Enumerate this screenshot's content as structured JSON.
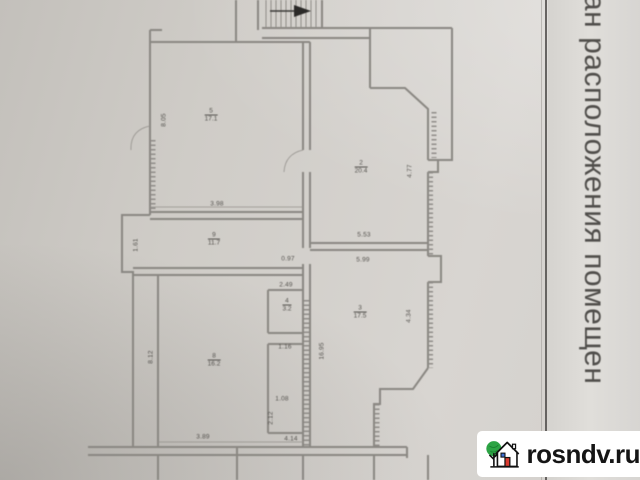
{
  "page": {
    "side_caption": "ан расположения помещен",
    "watermark": {
      "text": "rosndv.ru"
    }
  },
  "colors": {
    "paper": "#d2cfca",
    "plan_line": "#8a8782",
    "label_ink": "#55534f",
    "divider": "#514f4c",
    "watermark_bg": "#ffffff",
    "watermark_text": "#151515",
    "logo_green": "#2ca344",
    "logo_red": "#d93a2f",
    "logo_blue": "#3b6fd4"
  },
  "plan": {
    "room_labels": [
      {
        "num": "5",
        "area": "17.1",
        "x": 211,
        "y": 115
      },
      {
        "num": "2",
        "area": "20.4",
        "x": 361,
        "y": 167
      },
      {
        "num": "9",
        "area": "11.7",
        "x": 214,
        "y": 239
      },
      {
        "num": "4",
        "area": "3.2",
        "x": 287,
        "y": 305
      },
      {
        "num": "3",
        "area": "17.5",
        "x": 360,
        "y": 312
      },
      {
        "num": "8",
        "area": "16.2",
        "x": 214,
        "y": 360
      }
    ],
    "dimensions": [
      {
        "t": "8.05",
        "x": 164,
        "y": 120,
        "v": true
      },
      {
        "t": "3.98",
        "x": 217,
        "y": 204
      },
      {
        "t": "1.61",
        "x": 136,
        "y": 245,
        "v": true
      },
      {
        "t": "0.97",
        "x": 288,
        "y": 259
      },
      {
        "t": "5.53",
        "x": 364,
        "y": 235
      },
      {
        "t": "5.99",
        "x": 363,
        "y": 260
      },
      {
        "t": "4.77",
        "x": 410,
        "y": 171,
        "v": true
      },
      {
        "t": "4.34",
        "x": 409,
        "y": 316,
        "v": true
      },
      {
        "t": "16.95",
        "x": 322,
        "y": 351,
        "v": true
      },
      {
        "t": "2.49",
        "x": 286,
        "y": 285
      },
      {
        "t": "1.16",
        "x": 285,
        "y": 347
      },
      {
        "t": "3.89",
        "x": 203,
        "y": 437
      },
      {
        "t": "4.14",
        "x": 291,
        "y": 439
      },
      {
        "t": "1.08",
        "x": 282,
        "y": 399
      },
      {
        "t": "2.12",
        "x": 271,
        "y": 418,
        "v": true
      },
      {
        "t": "8.12",
        "x": 151,
        "y": 357,
        "v": true
      }
    ]
  }
}
